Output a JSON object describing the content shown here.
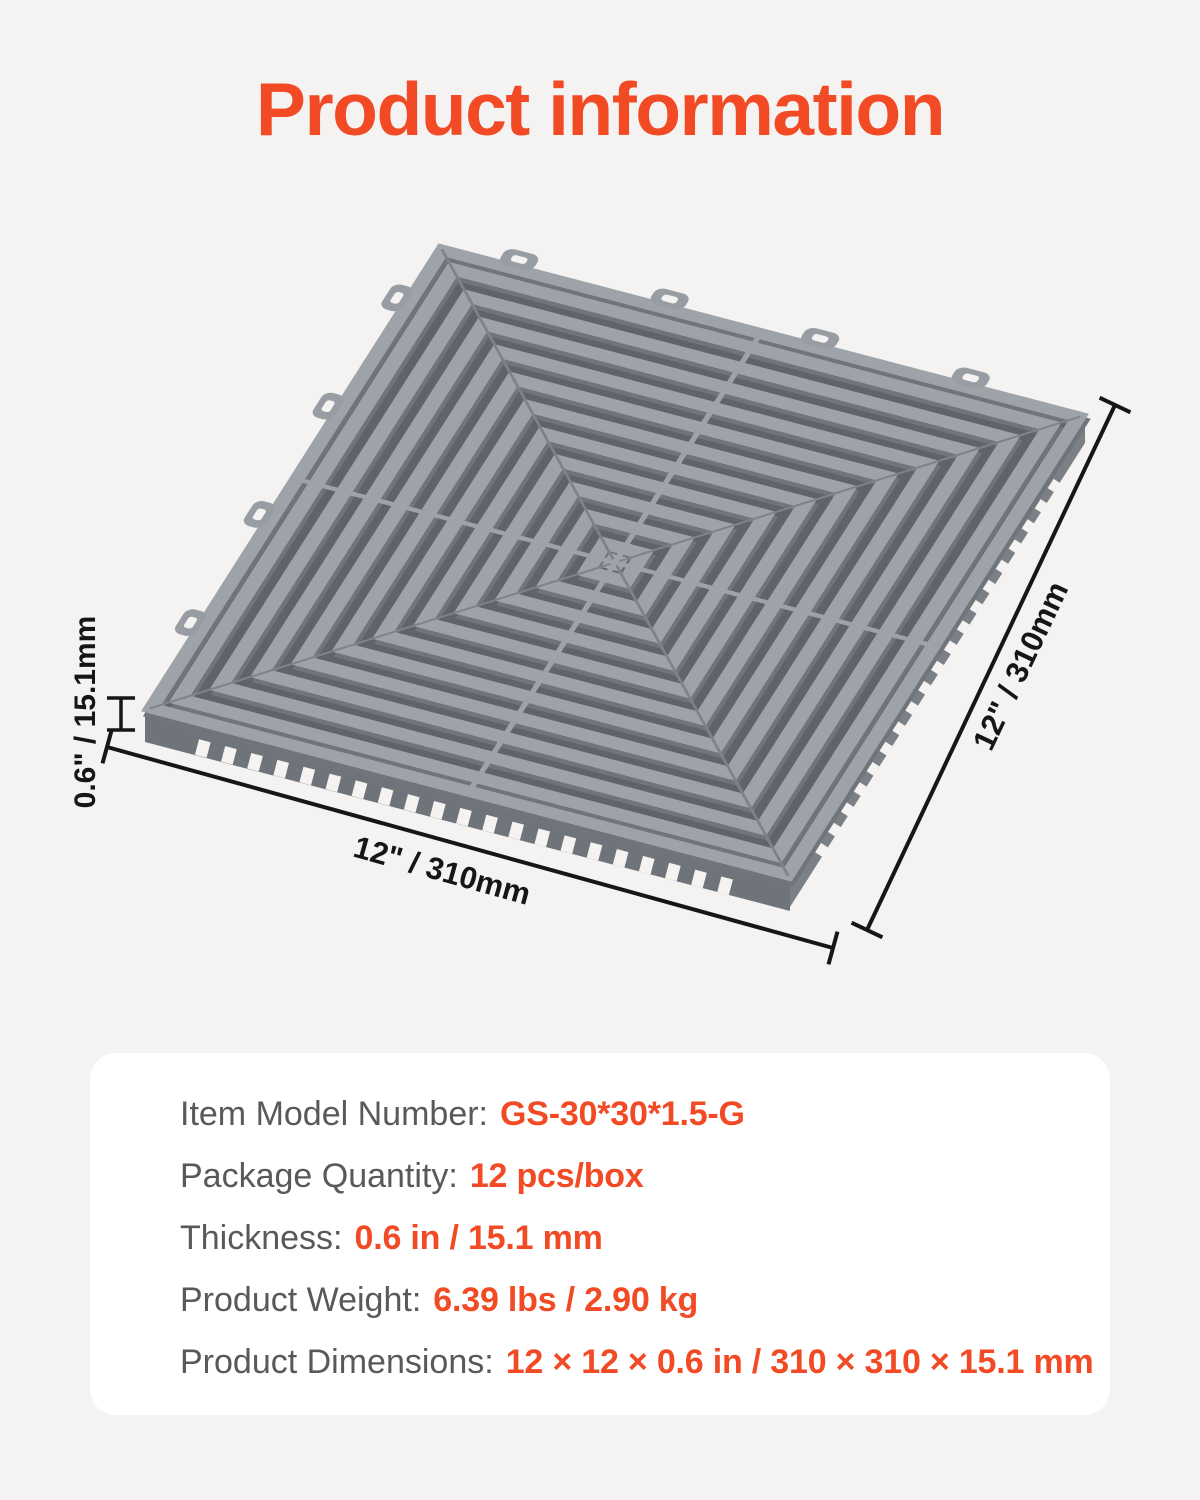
{
  "title": "Product information",
  "colors": {
    "background": "#f4f3f2",
    "accent": "#f14a24",
    "tile_gray": "#9ea3a9",
    "dimension_ink": "#161616",
    "spec_label_gray": "#595959",
    "card_background": "#ffffff"
  },
  "diagram": {
    "tile_name": "interlocking-vented-floor-tile",
    "thickness_label": "0.6\" / 15.1mm",
    "width_label": "12\" / 310mm",
    "depth_label": "12\" / 310mm"
  },
  "specs": {
    "rows": [
      {
        "label": "Item Model Number:",
        "value": "GS-30*30*1.5-G"
      },
      {
        "label": "Package Quantity:",
        "value": "12 pcs/box"
      },
      {
        "label": "Thickness:",
        "value": "0.6 in / 15.1 mm"
      },
      {
        "label": "Product Weight:",
        "value": "6.39 lbs / 2.90 kg"
      },
      {
        "label": "Product Dimensions:",
        "value": "12 × 12 × 0.6 in / 310 × 310 × 15.1 mm"
      }
    ]
  }
}
